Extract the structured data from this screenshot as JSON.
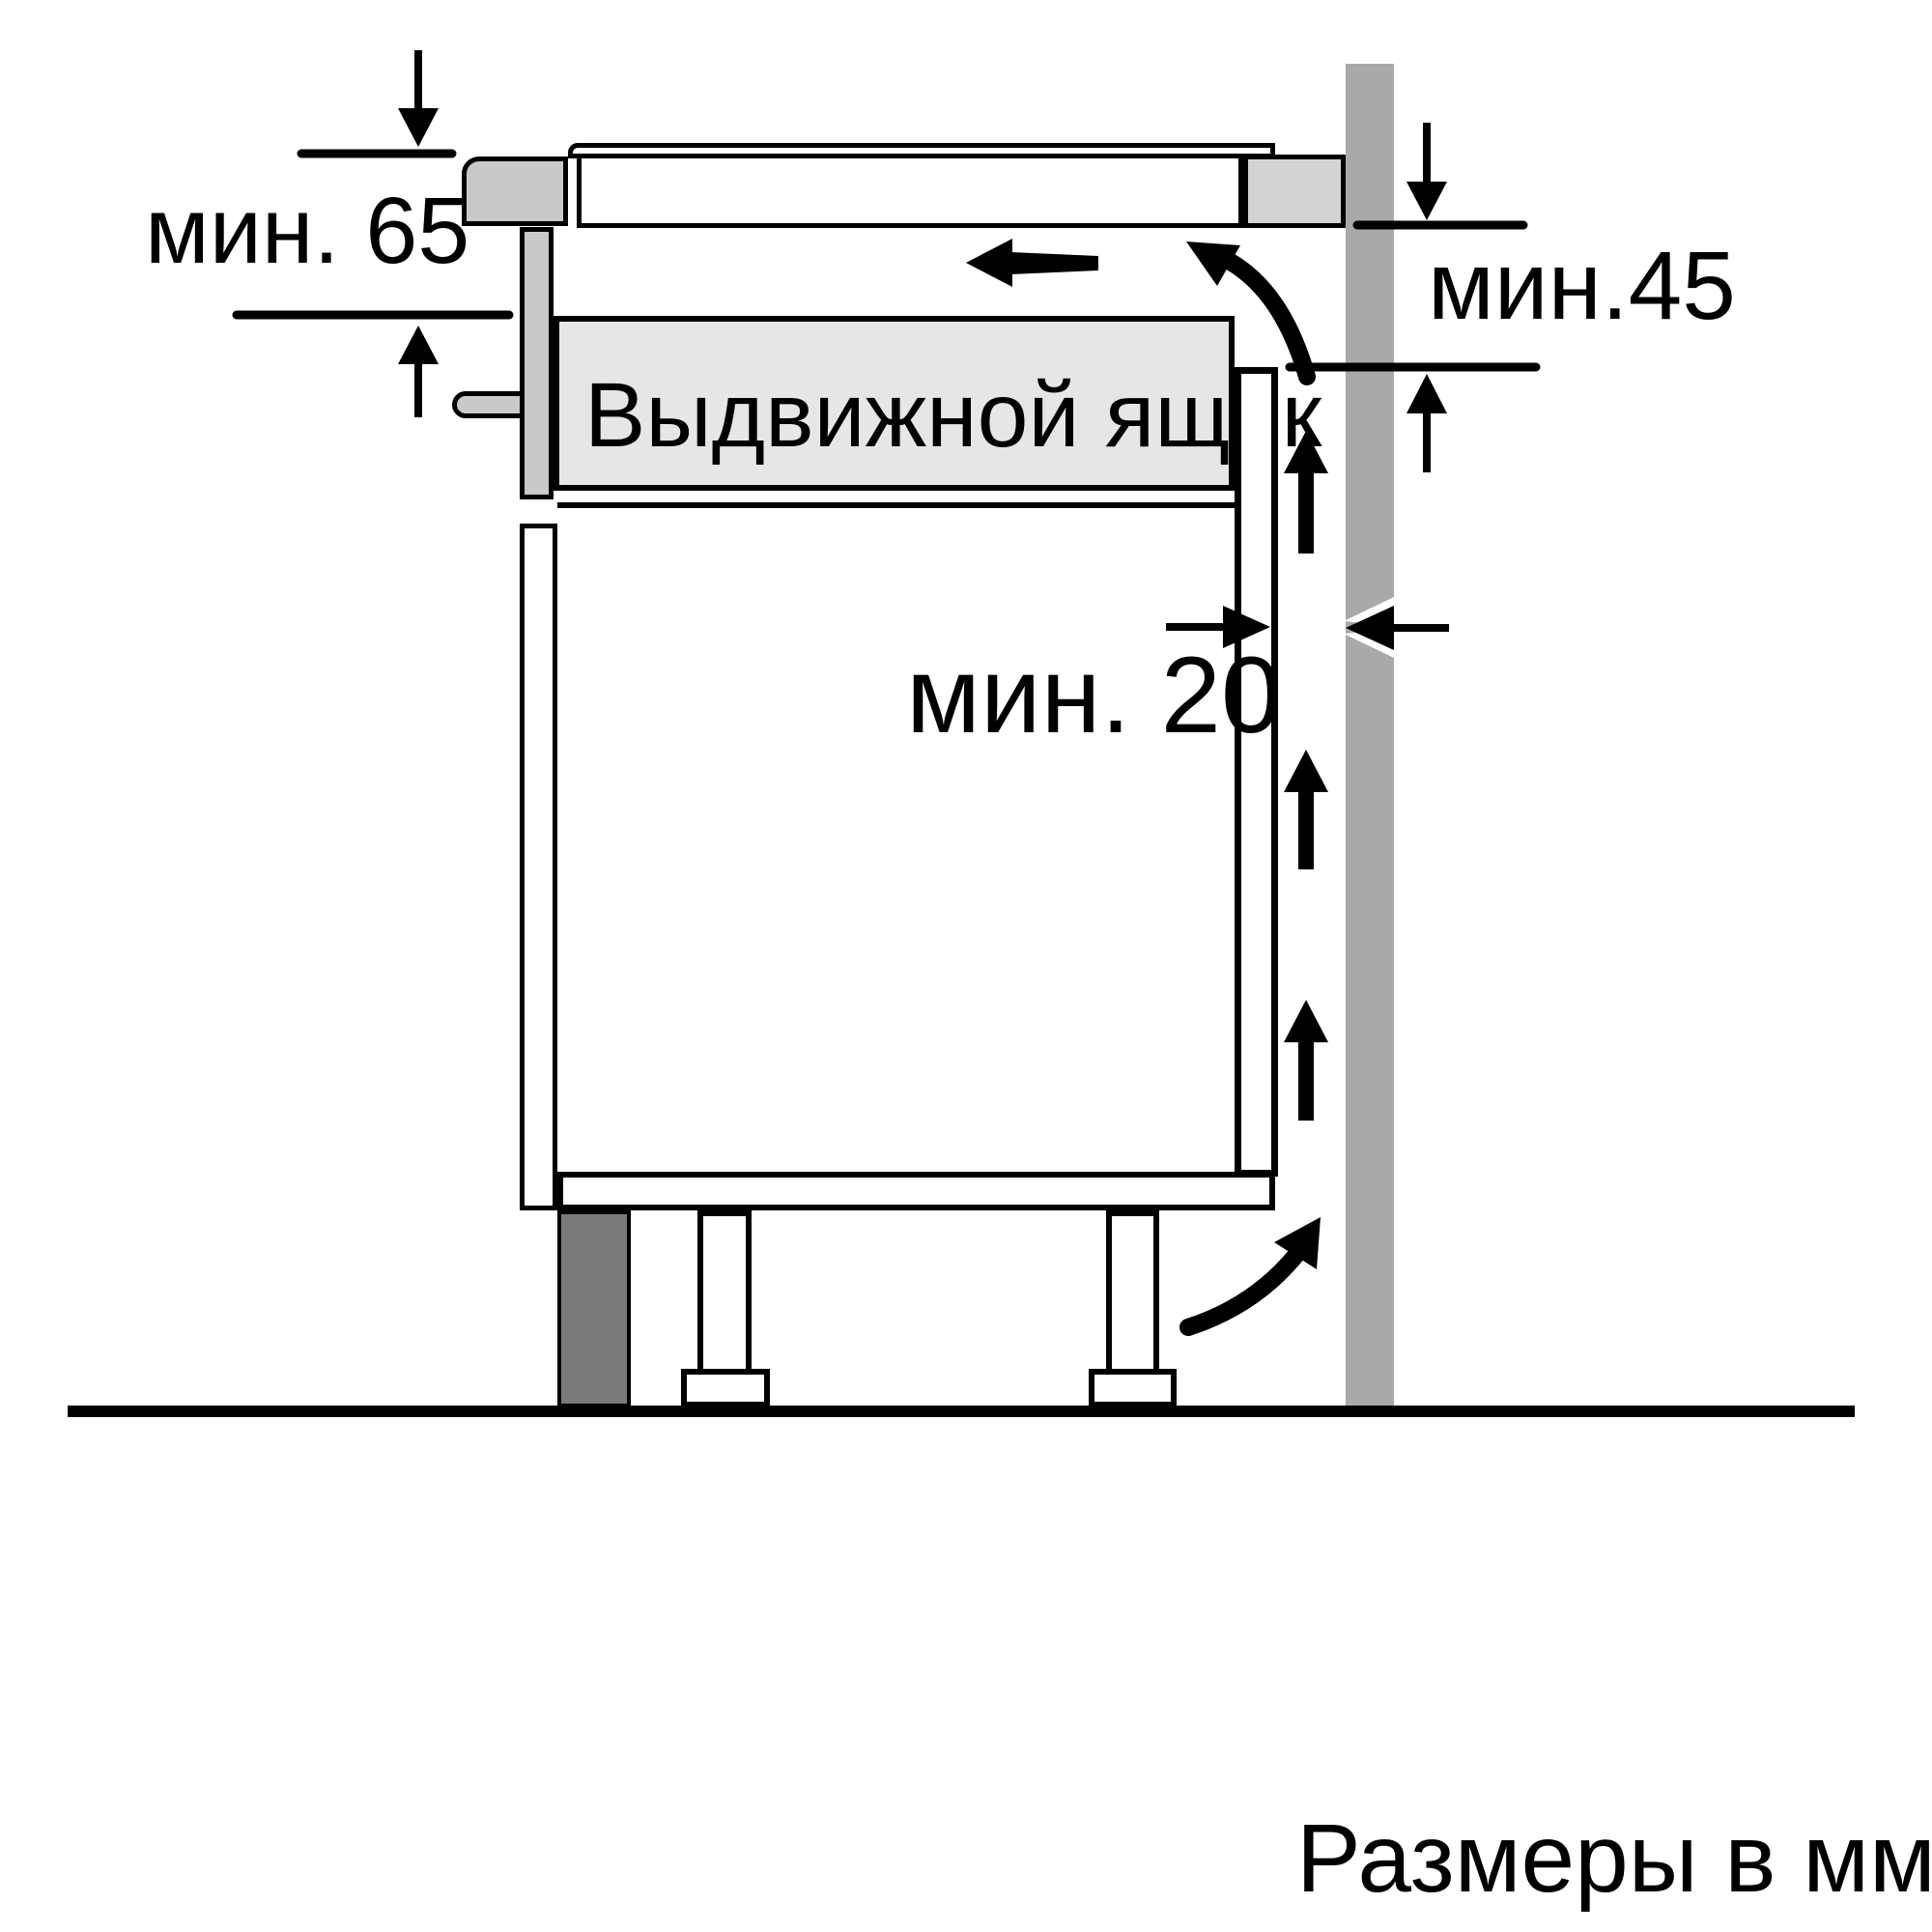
{
  "diagram": {
    "title": "Hob installation clearance diagram (side section)",
    "labels": {
      "dim_top_left": "мин. 65",
      "dim_right": "мин.45",
      "dim_gap": "мин. 20",
      "drawer": "Выдвижной ящик",
      "footer": "Размеры в мм"
    },
    "colors": {
      "line": "#000000",
      "background": "#ffffff",
      "wall": "#a9a9a9",
      "worktop_block": "#d3d3d3",
      "trim": "#c9c9c9",
      "drawer_fill": "#e6e6e6",
      "plinth": "#7a7a7a"
    }
  }
}
